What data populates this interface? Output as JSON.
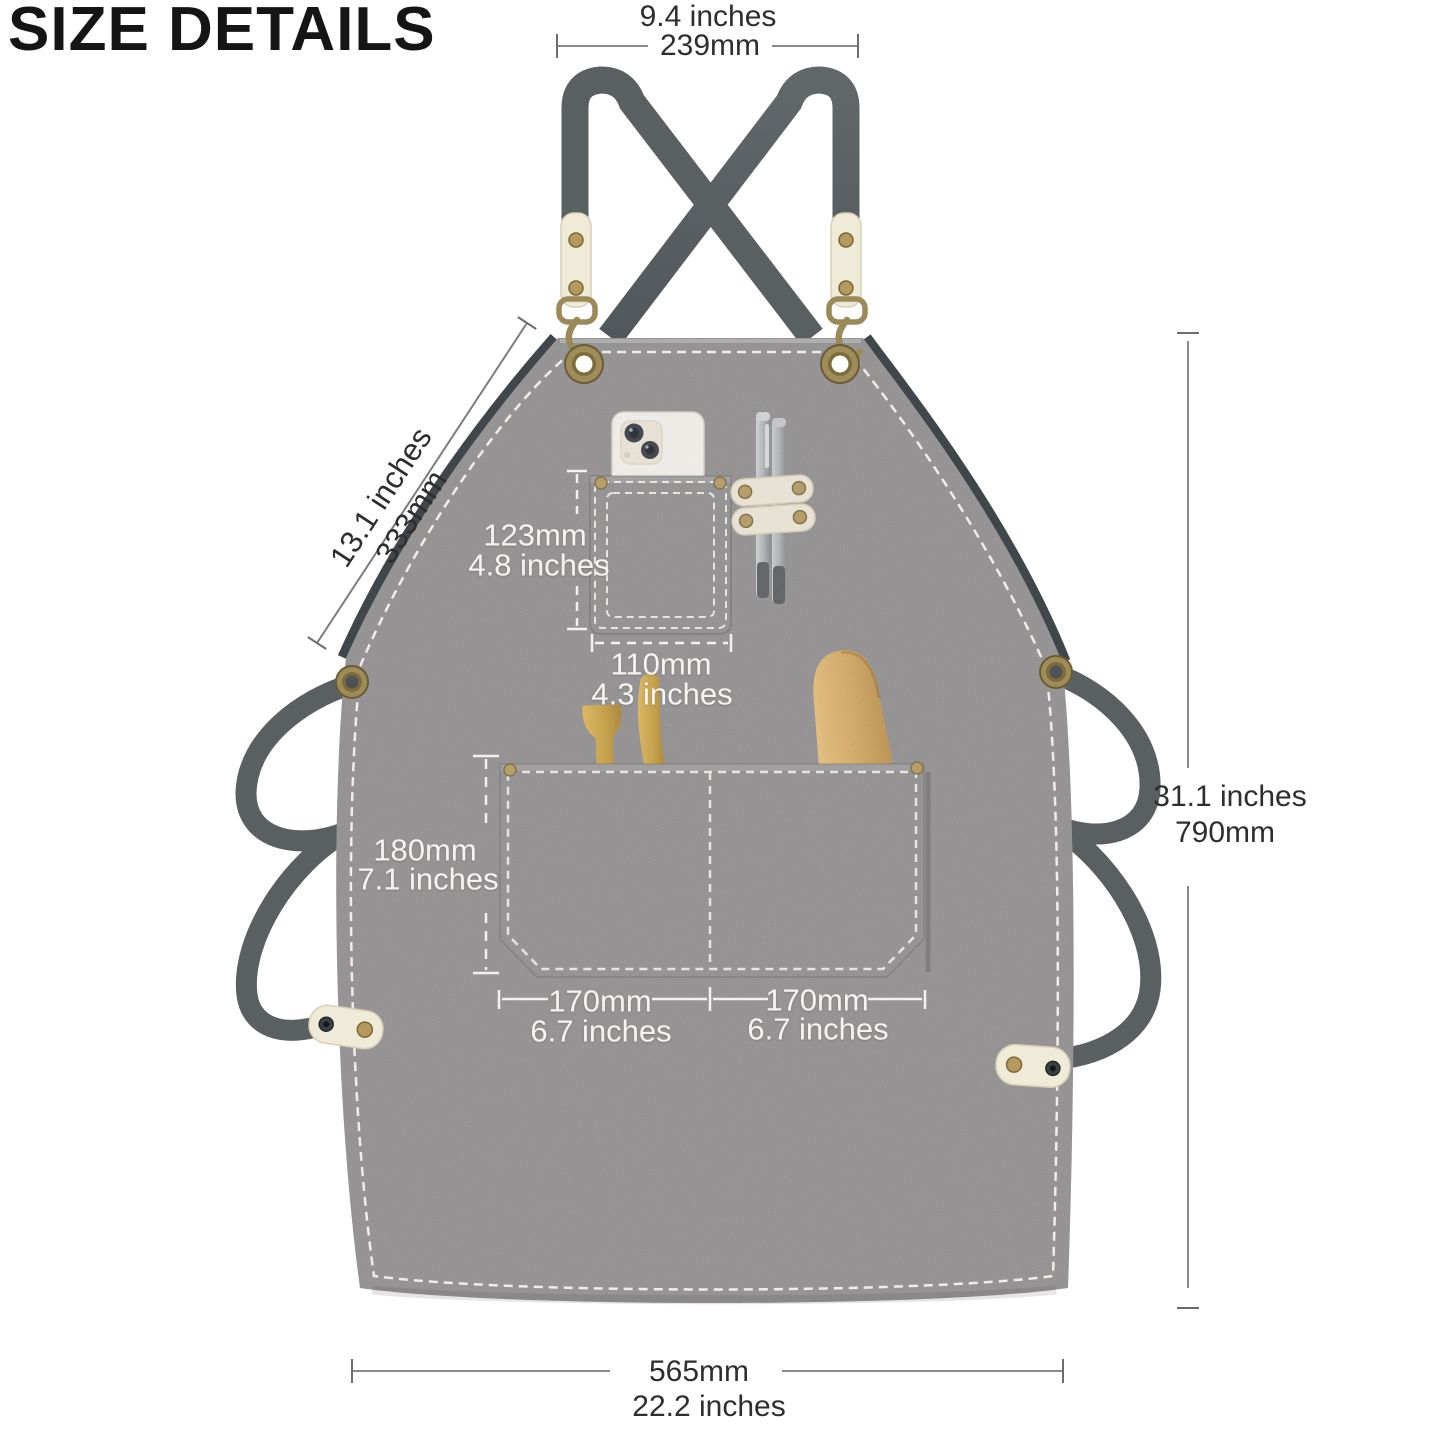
{
  "title": "SIZE DETAILS",
  "labels": {
    "top_width": {
      "line1": "9.4 inches",
      "line2": "239mm"
    },
    "neck_drop": {
      "line1": "13.1 inches",
      "line2": "333mm"
    },
    "chest_pocket_height": {
      "line1": "123mm",
      "line2": "4.8 inches"
    },
    "chest_pocket_width": {
      "line1": "110mm",
      "line2": "4.3 inches"
    },
    "main_pocket_height": {
      "line1": "180mm",
      "line2": "7.1 inches"
    },
    "main_pocket_left_width": {
      "line1": "170mm",
      "line2": "6.7 inches"
    },
    "main_pocket_right_width": {
      "line1": "170mm",
      "line2": "6.7 inches"
    },
    "overall_height": {
      "line1": "31.1 inches",
      "line2": "790mm"
    },
    "bottom_width": {
      "line1": "565mm",
      "line2": "22.2 inches"
    }
  },
  "colors": {
    "canvas": "#8f8d8e",
    "strap": "#5a5f61",
    "leather": "#f0ead9",
    "brass": "#ab9158",
    "stitching": "#f0ede6",
    "annotation_dark": "#2e2e2e",
    "annotation_light": "#f5f4f1"
  }
}
